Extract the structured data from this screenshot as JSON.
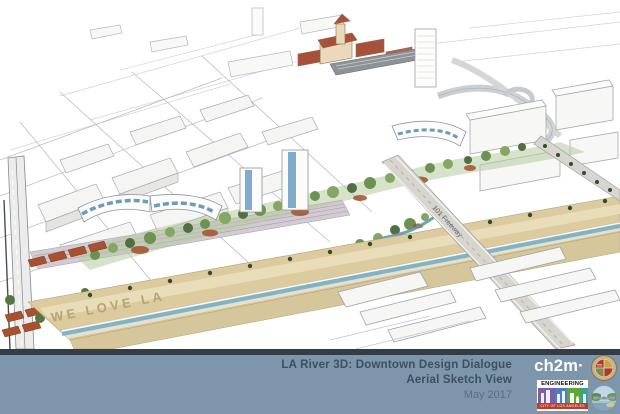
{
  "slide": {
    "title": "LA River 3D: Downtown Design Dialogue",
    "subtitle": "Aerial Sketch View",
    "date": "May 2017"
  },
  "sketch_labels": {
    "river_bank_text": "WE LOVE LA",
    "freeway_label": "101 Freeway"
  },
  "logos": {
    "ch2m": "ch2m·",
    "engineering": {
      "title": "ENGINEERING",
      "subtitle": "CITY OF LOS ANGELES"
    },
    "la_seal_icon": "city-of-los-angeles-seal",
    "river_badge_icon": "la-river-bridge-badge"
  },
  "colors": {
    "footer_bar": "#7e96ab",
    "footer_strip": "#323d48",
    "title_text": "#3e4f5e",
    "date_text": "#5d6f7e",
    "ch2m_text": "#ffffff",
    "engineering_red": "#bf3b2b",
    "seal_gold": "#c8b287",
    "river_water_blue": "#7fb3c6",
    "river_bank_sand": "#dccb9f",
    "tree_green": "#6d9150",
    "rust_red": "#a3502d",
    "pencil_gray": "#a6abb0"
  }
}
